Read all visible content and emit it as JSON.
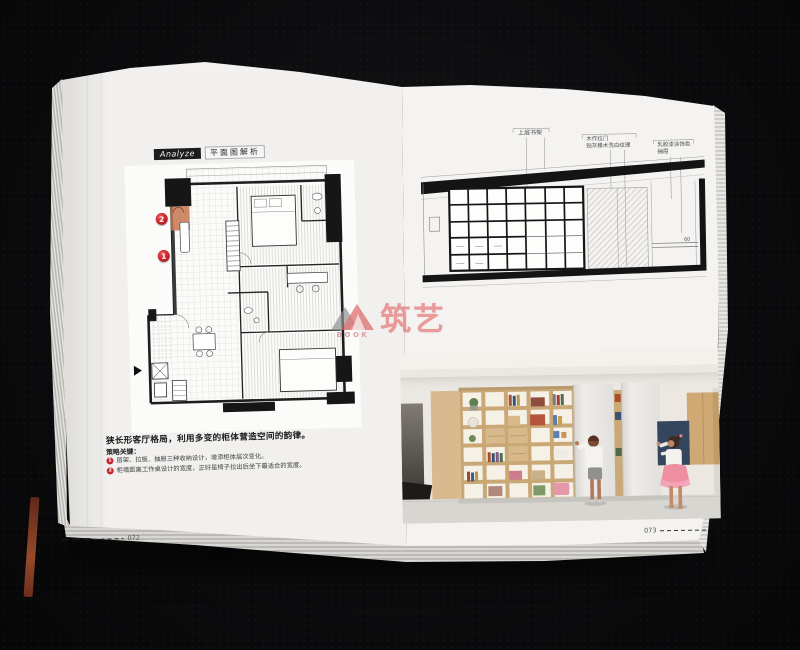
{
  "watermark": {
    "brand": "筑艺",
    "sub": "BOOK"
  },
  "left_page": {
    "analyze_tag": "Analyze",
    "plan_title": "平面图解析",
    "markers": [
      {
        "number": "1"
      },
      {
        "number": "2"
      }
    ],
    "caption_title": "狭长形客厅格局，利用多变的柜体营造空间的韵律。",
    "strategy_heading": "策略关键：",
    "strategy_items": [
      {
        "number": "1",
        "text": "层架、拉板、抽屉三种收纳设计，增添柜体层次变化。"
      },
      {
        "number": "2",
        "text": "柜墙距离工作桌设计的宽度，正好是椅子拉出后坐下最适合的宽度。"
      }
    ],
    "page_number": "072"
  },
  "right_page": {
    "elevation_labels": [
      {
        "lines": [
          "上层书架"
        ]
      },
      {
        "lines": [
          "木作拉门",
          "贴灰橡木洗白纹理"
        ]
      },
      {
        "lines": [
          "乳胶漆涂饰色",
          "抽屉"
        ]
      }
    ],
    "dimension_label": "60",
    "page_number": "073"
  },
  "colors": {
    "accent_red": "#c8242c",
    "highlight_orange": "#c5764f",
    "watermark_pink": "#de5555",
    "wood_tone": "#d9ba8e",
    "skirt_pink": "#ee8fa1",
    "drawing_ink": "#141414",
    "background": "#0c0c0e"
  }
}
